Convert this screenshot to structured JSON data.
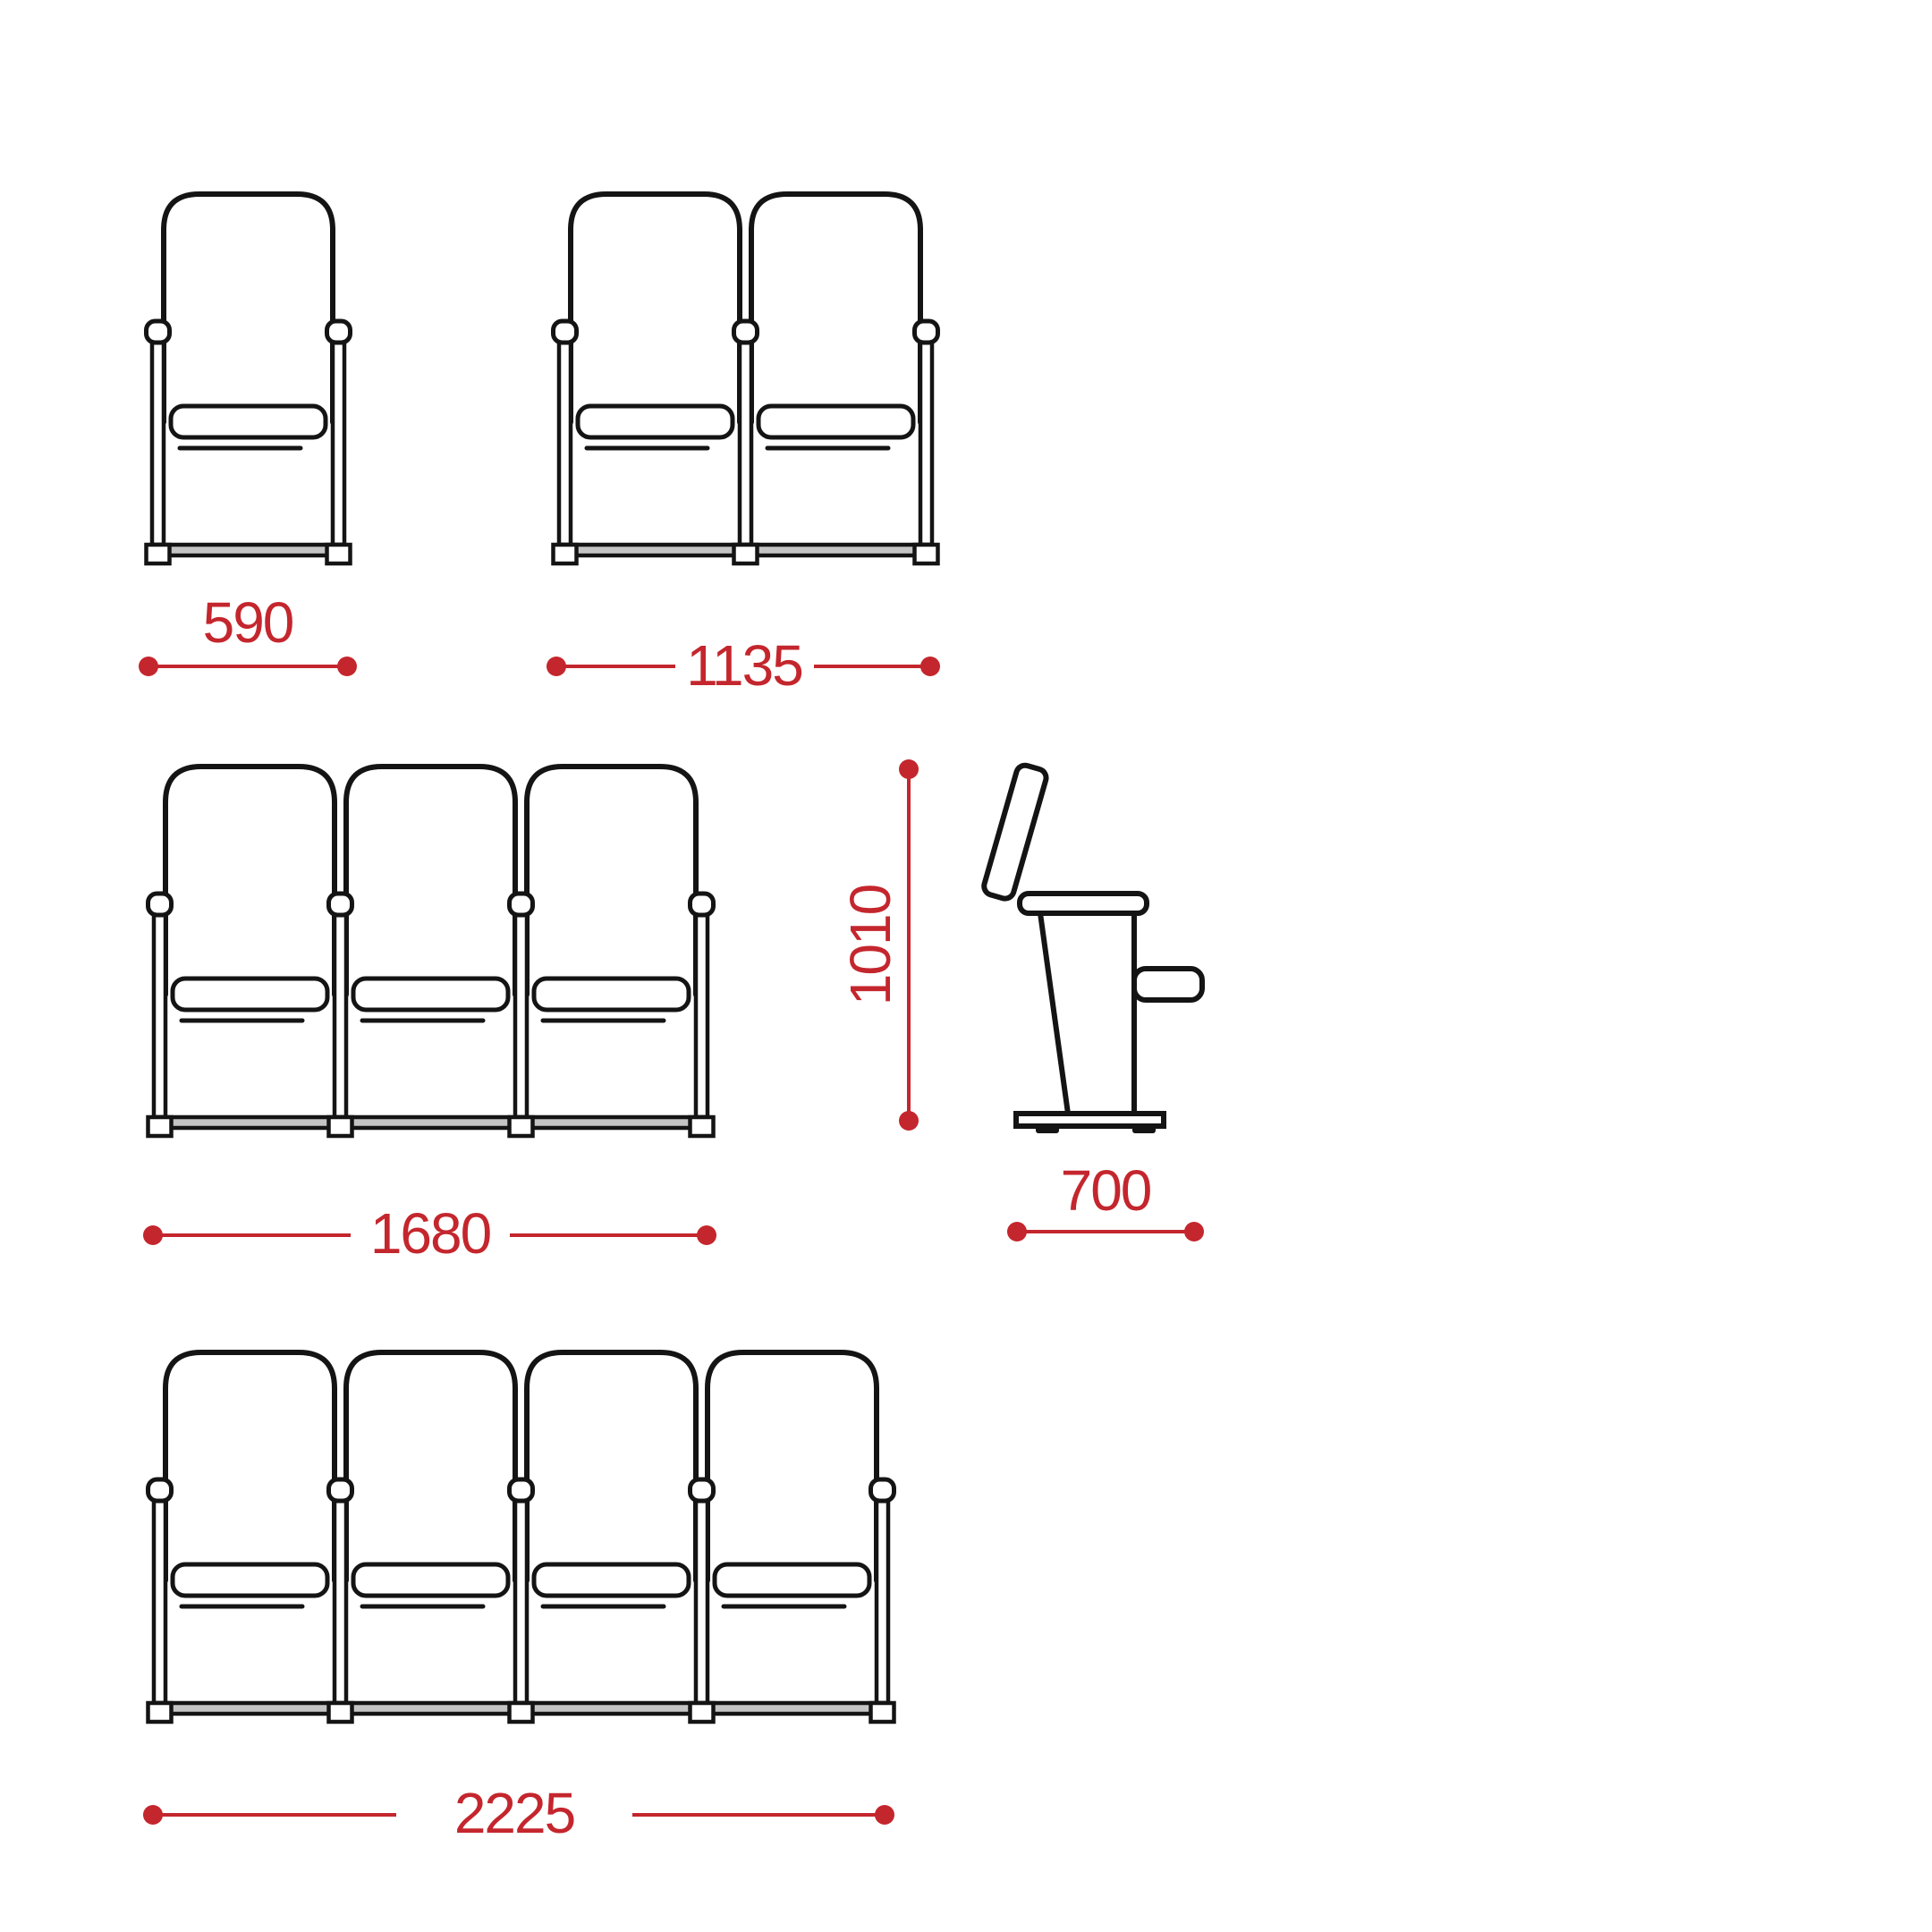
{
  "drawing": {
    "kind": "seating-row-dimension-diagram",
    "views": [
      {
        "id": "single-front",
        "seats": 1,
        "width_label": "590"
      },
      {
        "id": "double-front",
        "seats": 2,
        "width_label": "1135"
      },
      {
        "id": "triple-front",
        "seats": 3,
        "width_label": "1680"
      },
      {
        "id": "side-view",
        "height_label": "1010",
        "depth_label": "700"
      },
      {
        "id": "quad-front",
        "seats": 4,
        "width_label": "2225"
      }
    ]
  },
  "dimensions": {
    "single_width": "590",
    "double_width": "1135",
    "triple_width": "1680",
    "quad_width": "2225",
    "overall_height": "1010",
    "overall_depth": "700"
  },
  "colors": {
    "line_black": "#141414",
    "dimension_red": "#c4262d",
    "rail_gray": "#c4c4c4"
  }
}
